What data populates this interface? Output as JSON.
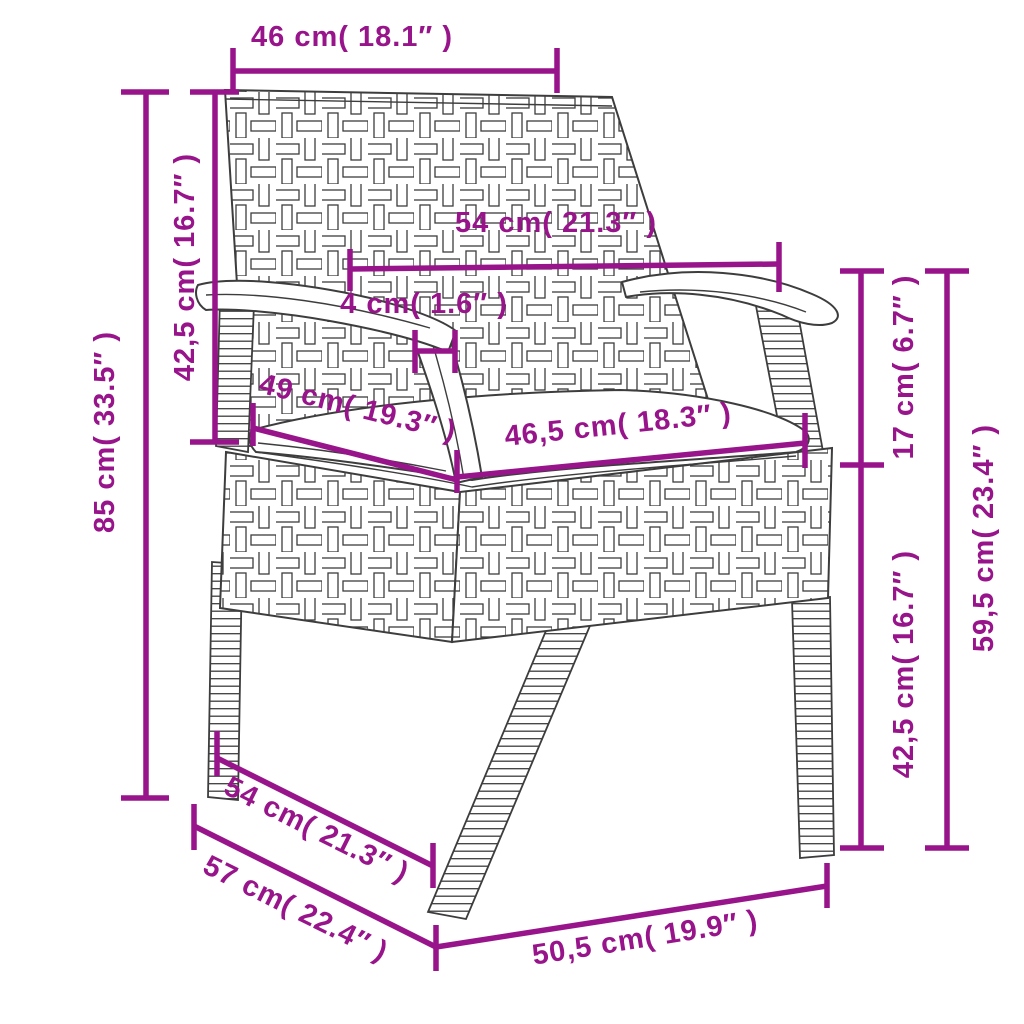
{
  "diagram": {
    "type": "product-dimension-diagram",
    "product": "poly-rattan garden chair with seat cushion",
    "accent_color": "#98148B",
    "line_color": "#3d3d3d",
    "dimensions": [
      {
        "id": "backrest-width",
        "cm": "46",
        "inch": "18.1",
        "label": "46 cm( 18.1″ )"
      },
      {
        "id": "backrest-height",
        "cm": "42,5",
        "inch": "16.7",
        "label": "42,5 cm( 16.7″ )"
      },
      {
        "id": "total-height",
        "cm": "85",
        "inch": "33.5",
        "label": "85 cm( 33.5″ )"
      },
      {
        "id": "armrest-span",
        "cm": "54",
        "inch": "21.3",
        "label": "54 cm( 21.3″ )"
      },
      {
        "id": "armrest-post-width",
        "cm": "4",
        "inch": "1.6",
        "label": "4 cm( 1.6″ )"
      },
      {
        "id": "seat-depth",
        "cm": "49",
        "inch": "19.3",
        "label": "49 cm( 19.3″ )"
      },
      {
        "id": "seat-width",
        "cm": "46,5",
        "inch": "18.3",
        "label": "46,5 cm( 18.3″ )"
      },
      {
        "id": "armrest-above-seat",
        "cm": "17",
        "inch": "6.7",
        "label": "17 cm( 6.7″ )"
      },
      {
        "id": "armrest-height",
        "cm": "59,5",
        "inch": "23.4",
        "label": "59,5 cm( 23.4″ )"
      },
      {
        "id": "seat-height",
        "cm": "42,5",
        "inch": "16.7",
        "label": "42,5 cm( 16.7″ )"
      },
      {
        "id": "base-depth-inner",
        "cm": "54",
        "inch": "21.3",
        "label": "54 cm( 21.3″ )"
      },
      {
        "id": "base-depth-outer",
        "cm": "57",
        "inch": "22.4",
        "label": "57 cm( 22.4″ )"
      },
      {
        "id": "base-width",
        "cm": "50,5",
        "inch": "19.9",
        "label": "50,5 cm( 19.9″ )"
      }
    ]
  }
}
